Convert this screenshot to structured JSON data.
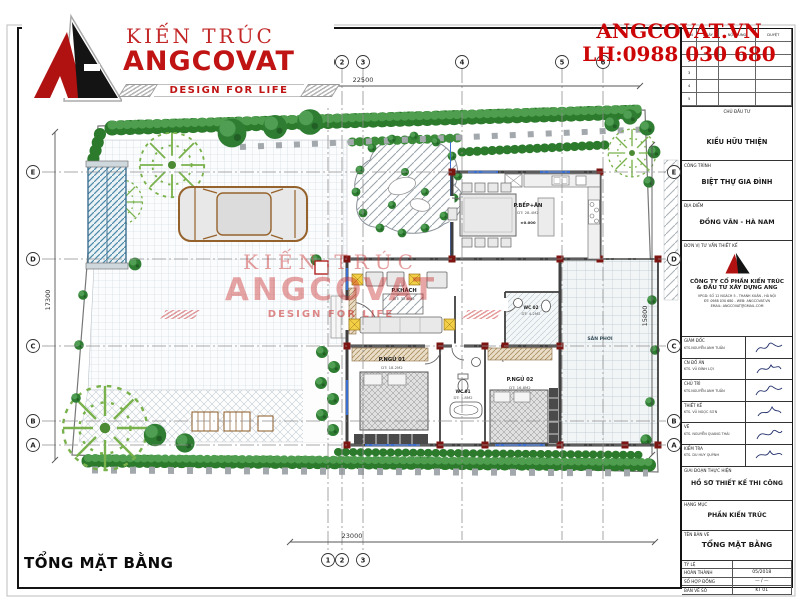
{
  "branding": {
    "kien_truc": "KIẾN TRÚC",
    "name": "ANGCOVAT",
    "tagline": "DESIGN FOR LIFE",
    "website": "ANGCOVAT.VN",
    "hotline": "LH:0988 030 680"
  },
  "watermark": {
    "l1": "KIẾN TRÚC",
    "l2": "ANGCOVAT",
    "l3": "DESIGN FOR LIFE"
  },
  "plan": {
    "title": "TỔNG MẶT BẰNG",
    "dims": {
      "top": "22500",
      "bottom": "23000",
      "left": "17300",
      "right": "15800"
    },
    "grid_cols": [
      "1",
      "2",
      "3",
      "4",
      "5",
      "6"
    ],
    "grid_rows": [
      "E",
      "D",
      "C",
      "B",
      "A"
    ],
    "rooms": {
      "kitchen": {
        "label": "P.BẾP+ĂN",
        "area": "DT: 28.4M2",
        "level": "±0.000"
      },
      "living": {
        "label": "P.KHÁCH",
        "area": "DT: 32.6M2"
      },
      "bed1": {
        "label": "P.NGỦ 01",
        "area": "DT: 18.2M2"
      },
      "bed2": {
        "label": "P.NGỦ 02",
        "area": "DT: 16.8M2"
      },
      "wc1": {
        "label": "WC 01",
        "area": "DT: 5.8M2"
      },
      "wc2": {
        "label": "WC 02",
        "area": "DT: 4.2M2"
      },
      "yard": {
        "label": "SÂN PHƠI"
      }
    }
  },
  "titleblock": {
    "revision": {
      "cols": [
        "LẦN",
        "NGÀY",
        "NỘI DUNG",
        "DUYỆT"
      ],
      "rows": [
        "1",
        "2",
        "3",
        "4",
        "5"
      ]
    },
    "investor": {
      "label": "CHỦ ĐẦU TƯ",
      "value": "KIỀU HỮU THIỆN"
    },
    "project": {
      "label": "CÔNG TRÌNH",
      "value": "BIỆT THỰ GIA ĐÌNH"
    },
    "location": {
      "label": "ĐỊA ĐIỂM",
      "value": "ĐỒNG VĂN - HÀ NAM"
    },
    "consultant": {
      "label": "ĐƠN VỊ TƯ VẤN THIẾT KẾ",
      "company1": "CÔNG TY CỔ PHẦN KIẾN TRÚC",
      "company2": "& ĐẦU TƯ XÂY DỰNG  ANG",
      "addr1": "VPGD: SỐ 12 NGÁCH 5 - THANH XUÂN - HÀ NỘI",
      "addr2": "ĐT: 0988 030 680 - WEB: ANGCOVAT.VN",
      "addr3": "EMAIL: ANGCOVAT@GMAIL.COM"
    },
    "signatures": [
      {
        "label": "GIÁM ĐỐC",
        "name": "KTS.NGUYỄN ANH TUẤN"
      },
      {
        "label": "CN ĐỒ ÁN",
        "name": "KTS. VŨ ĐÌNH LỢI"
      },
      {
        "label": "CHỦ TRÌ",
        "name": "KTS.NGUYỄN ANH TUẤN"
      },
      {
        "label": "THIẾT KẾ",
        "name": "KTS. VŨ NGỌC SƠN"
      },
      {
        "label": "VẼ",
        "name": "KTS. NGUYỄN QUANG THÁI"
      },
      {
        "label": "KIỂM TRA",
        "name": "KTS. DU HUY QUỲNH"
      }
    ],
    "stage": {
      "label": "GIAI ĐOẠN THỰC HIỆN",
      "value": "HỒ SƠ THIẾT KẾ THI CÔNG"
    },
    "category": {
      "label": "HẠNG MỤC",
      "value": "PHẦN KIẾN TRÚC"
    },
    "sheet_name": {
      "label": "TÊN BẢN VẼ",
      "value": "TỔNG MẶT BẰNG"
    },
    "meta": [
      {
        "label": "TỶ LỆ",
        "value": ""
      },
      {
        "label": "HOÀN THÀNH",
        "value": "05/2018"
      },
      {
        "label": "SỐ HỢP ĐỒNG",
        "value": "— / —"
      },
      {
        "label": "BẢN VẼ SỐ",
        "value": "KT 01"
      }
    ]
  },
  "colors": {
    "accent_red": "#cc0606",
    "hedge_green": "#2c7a2c",
    "column_red": "#7c1512"
  }
}
